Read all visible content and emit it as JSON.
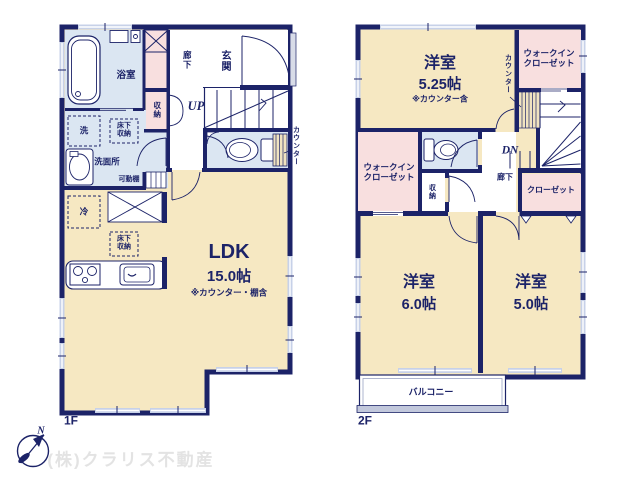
{
  "f1": {
    "floor": "1F",
    "bath": "浴室",
    "corridor": "廊下",
    "entrance": "玄関",
    "up": "UP",
    "storage": "収納",
    "washer": "洗",
    "underfloor1": "床下\n収納",
    "washroom": "洗面所",
    "shelf": "可動棚",
    "counter": "カウンター",
    "fridge": "冷",
    "underfloor2": "床下\n収納",
    "ldk": "LDK",
    "ldk_size": "15.0帖",
    "ldk_note": "※カウンター・棚含"
  },
  "f2": {
    "floor": "2F",
    "room_a": "洋室",
    "room_a_size": "5.25帖",
    "room_a_note": "※カウンター含",
    "wic_a": "ウォークイン\nクローゼット",
    "counter": "カウンター",
    "dn": "DN",
    "corridor": "廊下",
    "wic_b": "ウォークイン\nクローゼット",
    "storage": "収納",
    "closet": "クローゼット",
    "room_b": "洋室",
    "room_b_size": "6.0帖",
    "room_c": "洋室",
    "room_c_size": "5.0帖",
    "balcony": "バルコニー"
  },
  "footer": {
    "company": "(株)クラリス不動産",
    "north": "N"
  },
  "colors": {
    "wall": "#1c2368",
    "room_cream": "#f6e8c2",
    "wet_blue": "#dbe6f2",
    "closet_pink": "#f8dfdf",
    "window": "#c7d1e8",
    "counter_hatch": "#f0e3c0",
    "balcony_rail": "#c2c8dc",
    "company_text": "#e3e3e3"
  }
}
